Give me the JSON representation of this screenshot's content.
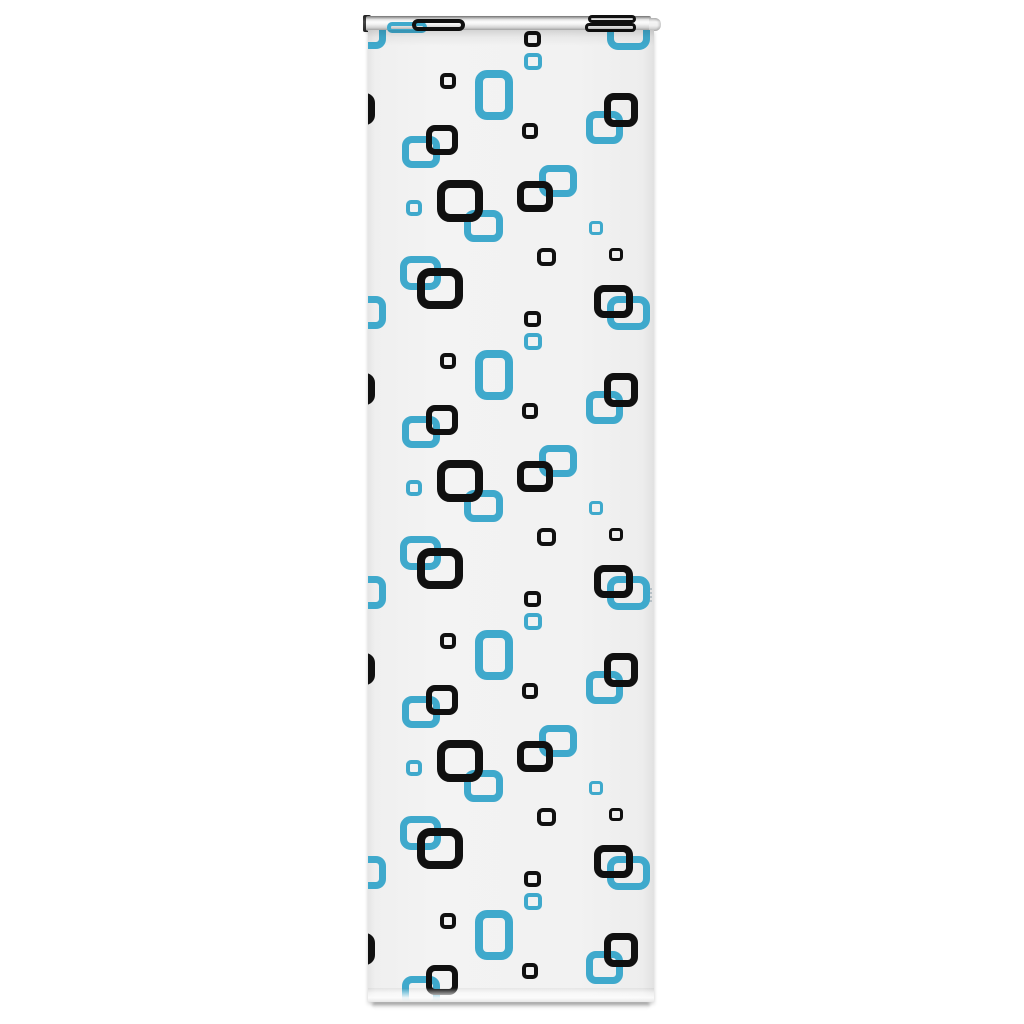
{
  "title": "Roller blind with black and blue retro squares pattern - product photo",
  "colors": {
    "page_bg": "#ffffff",
    "blue": "#3fa9cc",
    "black": "#101010",
    "fabric_base": "#f2f2f2",
    "roller_silver": "#d9d9d9",
    "bracket_dark": "#2e2e2e"
  },
  "blind": {
    "fabric": {
      "x": 368,
      "y": 30,
      "w": 286,
      "h": 972
    },
    "roller_tube": {
      "x": 366,
      "y": 16,
      "w": 285,
      "h": 15
    },
    "left_bracket": {
      "x": 363,
      "y": 15,
      "w": 8,
      "h": 17
    },
    "right_cap": {
      "x": 649,
      "y": 18,
      "w": 12,
      "h": 13
    },
    "bottom_shadow": {
      "x": 372,
      "y": 1002,
      "w": 278,
      "h": 7
    },
    "selvage_mark": {
      "x": 649,
      "y": 588,
      "w": 3,
      "h": 15
    }
  },
  "pattern": {
    "description": "Repeating motif of rounded outline squares, petrol blue behind, black on top, on off-white fabric",
    "tile_height": 280,
    "tiles": [
      {
        "y": -215,
        "from_rely": 228
      },
      {
        "y": 65
      },
      {
        "y": 345
      },
      {
        "y": 625
      },
      {
        "y": 905
      }
    ],
    "squares": [
      {
        "id": "blue-tall-rect",
        "color": "blue",
        "x": 475,
        "rely": 5,
        "w": 38,
        "h": 50,
        "bw": 8,
        "r": 12
      },
      {
        "id": "blue-mid-right-top",
        "color": "blue",
        "x": 586,
        "rely": 46,
        "w": 37,
        "h": 33,
        "bw": 7,
        "r": 10
      },
      {
        "id": "blue-mid-left-top",
        "color": "blue",
        "x": 402,
        "rely": 71,
        "w": 38,
        "h": 32,
        "bw": 7,
        "r": 10
      },
      {
        "id": "blue-center",
        "color": "blue",
        "x": 539,
        "rely": 100,
        "w": 38,
        "h": 32,
        "bw": 7,
        "r": 10
      },
      {
        "id": "blue-under-large",
        "color": "blue",
        "x": 464,
        "rely": 145,
        "w": 39,
        "h": 32,
        "bw": 7,
        "r": 10
      },
      {
        "id": "blue-small-left",
        "color": "blue",
        "x": 406,
        "rely": 135,
        "w": 16,
        "h": 16,
        "bw": 4,
        "r": 5
      },
      {
        "id": "blue-small-right",
        "color": "blue",
        "x": 589,
        "rely": 156,
        "w": 14,
        "h": 14,
        "bw": 3,
        "r": 4
      },
      {
        "id": "blue-lower-left",
        "color": "blue",
        "x": 400,
        "rely": 191,
        "w": 41,
        "h": 34,
        "bw": 7,
        "r": 11
      },
      {
        "id": "blue-lower-right",
        "color": "blue",
        "x": 607,
        "rely": 231,
        "w": 43,
        "h": 34,
        "bw": 7,
        "r": 11
      },
      {
        "id": "blue-left-clipped",
        "color": "blue",
        "x": 348,
        "rely": 231,
        "w": 38,
        "h": 33,
        "bw": 7,
        "r": 10
      },
      {
        "id": "blue-small-stack",
        "color": "blue",
        "x": 524,
        "rely": 268,
        "w": 18,
        "h": 17,
        "bw": 4,
        "r": 5
      },
      {
        "id": "black-small-top",
        "color": "black",
        "x": 440,
        "rely": 8,
        "w": 16,
        "h": 16,
        "bw": 4,
        "r": 5
      },
      {
        "id": "black-left-clipped",
        "color": "black",
        "x": 341,
        "rely": 28,
        "w": 34,
        "h": 32,
        "bw": 7,
        "r": 10
      },
      {
        "id": "black-top-right",
        "color": "black",
        "x": 604,
        "rely": 28,
        "w": 34,
        "h": 34,
        "bw": 7,
        "r": 10
      },
      {
        "id": "black-mid-left",
        "color": "black",
        "x": 426,
        "rely": 60,
        "w": 32,
        "h": 30,
        "bw": 6,
        "r": 9
      },
      {
        "id": "black-small-mid",
        "color": "black",
        "x": 522,
        "rely": 58,
        "w": 16,
        "h": 16,
        "bw": 4,
        "r": 5
      },
      {
        "id": "black-large-center",
        "color": "black",
        "x": 437,
        "rely": 115,
        "w": 46,
        "h": 42,
        "bw": 8,
        "r": 13
      },
      {
        "id": "black-center-right",
        "color": "black",
        "x": 517,
        "rely": 116,
        "w": 36,
        "h": 31,
        "bw": 7,
        "r": 10
      },
      {
        "id": "black-small-low-mid",
        "color": "black",
        "x": 537,
        "rely": 183,
        "w": 19,
        "h": 18,
        "bw": 4,
        "r": 6
      },
      {
        "id": "black-small-low-rt",
        "color": "black",
        "x": 609,
        "rely": 183,
        "w": 14,
        "h": 13,
        "bw": 3,
        "r": 4
      },
      {
        "id": "black-large-lower",
        "color": "black",
        "x": 417,
        "rely": 203,
        "w": 46,
        "h": 41,
        "bw": 8,
        "r": 13
      },
      {
        "id": "black-lower-right",
        "color": "black",
        "x": 594,
        "rely": 220,
        "w": 39,
        "h": 33,
        "bw": 7,
        "r": 10
      },
      {
        "id": "black-small-stack",
        "color": "black",
        "x": 524,
        "rely": 246,
        "w": 17,
        "h": 16,
        "bw": 4,
        "r": 5
      }
    ],
    "roller_wrap_bars": [
      {
        "id": "wrap-blue-left",
        "color": "blue",
        "x": 387,
        "y": 22,
        "w": 40,
        "h": 11,
        "bw": 4,
        "r": 5
      },
      {
        "id": "wrap-black-left",
        "color": "black",
        "x": 412,
        "y": 19,
        "w": 53,
        "h": 12,
        "bw": 4,
        "r": 6
      },
      {
        "id": "wrap-black-right-upper",
        "color": "black",
        "x": 588,
        "y": 15,
        "w": 48,
        "h": 8,
        "bw": 3,
        "r": 4
      },
      {
        "id": "wrap-black-right-lower",
        "color": "black",
        "x": 585,
        "y": 23,
        "w": 51,
        "h": 9,
        "bw": 3,
        "r": 4
      }
    ]
  }
}
